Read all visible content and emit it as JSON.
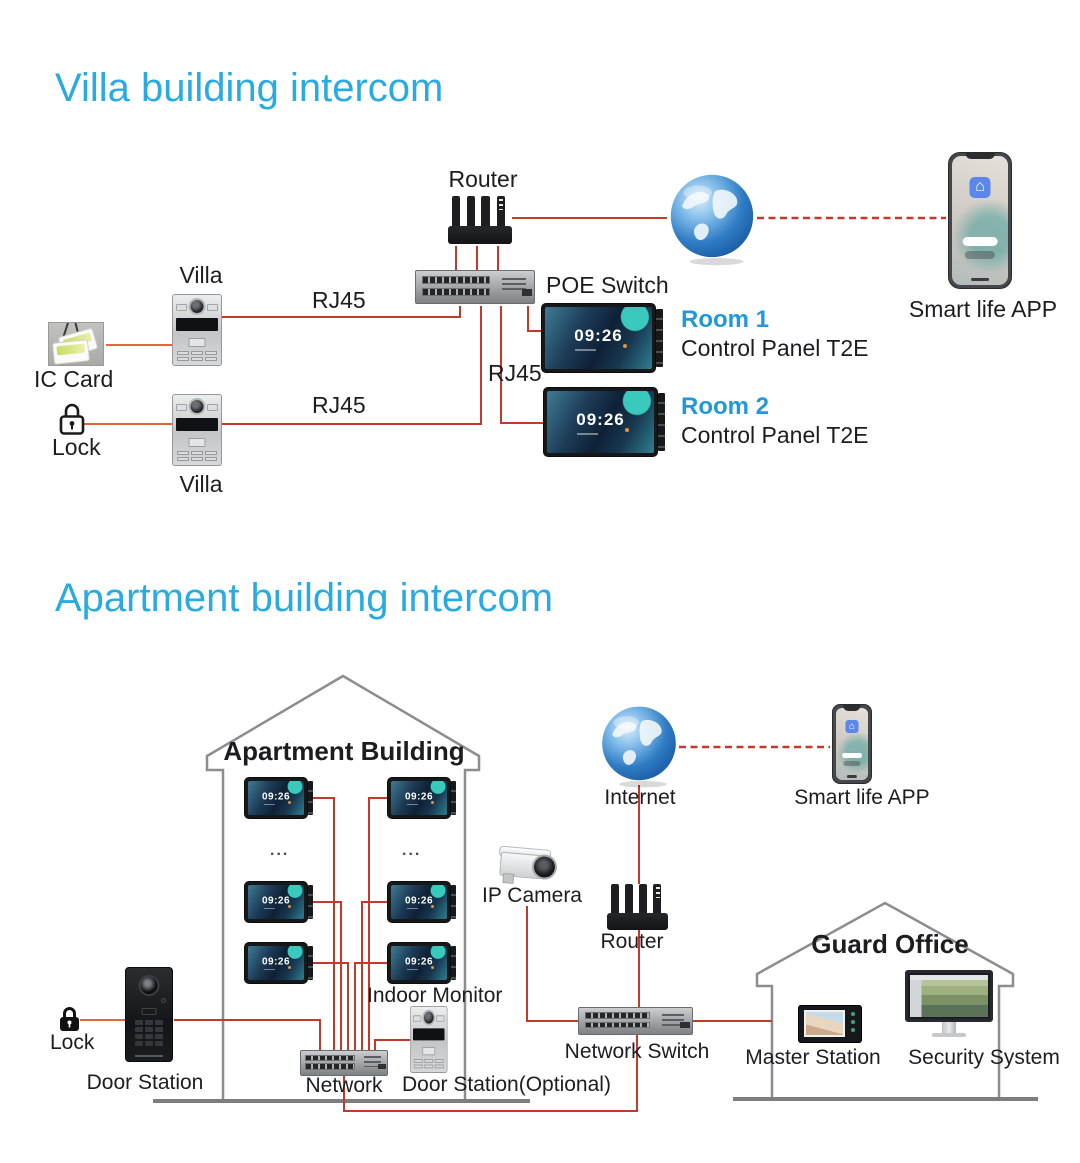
{
  "colors": {
    "accent": "#29abe2",
    "room_blue": "#2199d6",
    "line_red": "#c43a2a",
    "line_orange": "#e2663c"
  },
  "monitor": {
    "time": "09:26"
  },
  "villa": {
    "title": "Villa building intercom",
    "router_label": "Router",
    "poe_switch_label": "POE Switch",
    "rj45_top": "RJ45",
    "rj45_mid": "RJ45",
    "rj45_bottom": "RJ45",
    "villa_top_label": "Villa",
    "villa_bottom_label": "Villa",
    "ic_card_label": "IC Card",
    "lock_label": "Lock",
    "smart_life_label": "Smart life APP",
    "rooms": [
      {
        "name": "Room 1",
        "device": "Control Panel T2E"
      },
      {
        "name": "Room 2",
        "device": "Control Panel T2E"
      }
    ]
  },
  "apartment": {
    "title": "Apartment building intercom",
    "building_label": "Apartment Building",
    "ellipsis": "...",
    "indoor_monitor_label": "Indoor Monitor",
    "network_label": "Network",
    "door_station_optional_label": "Door Station(Optional)",
    "door_station_label": "Door Station",
    "lock_label": "Lock",
    "ip_camera_label": "IP Camera",
    "internet_label": "Internet",
    "router_label": "Router",
    "smart_life_label": "Smart life APP",
    "network_switch_label": "Network Switch",
    "guard_office_label": "Guard Office",
    "master_station_label": "Master Station",
    "security_system_label": "Security System"
  }
}
